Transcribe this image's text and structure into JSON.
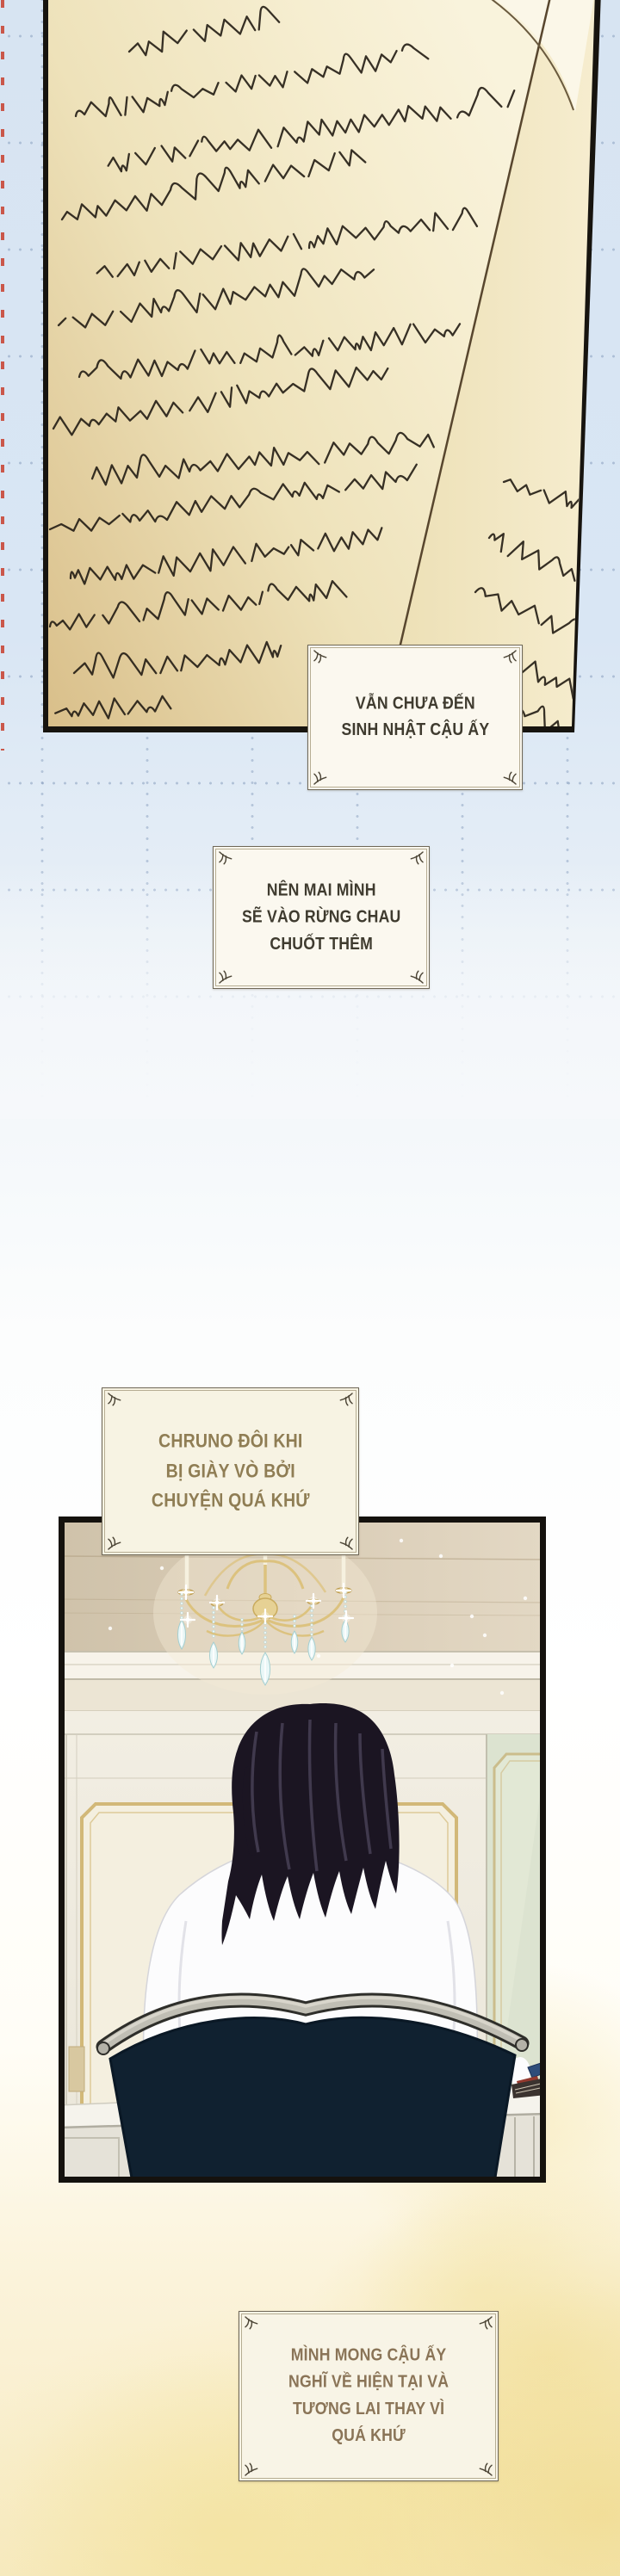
{
  "captions": {
    "journal_note_1": {
      "text": "VẪN CHƯA ĐẾN\nSINH NHẬT CẬU ẤY"
    },
    "journal_note_2": {
      "text": "NÊN MAI MÌNH\nSẼ VÀO RỪNG CHAU\nCHUỐT THÊM"
    },
    "narration_1": {
      "text": "CHRUNO ĐÔI KHI\nBỊ GIÀY VÒ BỞI\nCHUYỆN QUÁ KHỨ"
    },
    "narration_2": {
      "text": "MÌNH MONG CẬU ẤY\nNGHĨ VỀ HIỆN TẠI VÀ\nTƯƠNG LAI THAY VÌ\nQUÁ KHỨ"
    }
  },
  "colors": {
    "background_blue": "#d9e6f4",
    "paper_cream": "#e9d7a6",
    "caption_box_bg": "#f9f5ea",
    "caption_dark_text": "#3f3b2f",
    "caption_olive_text": "#8f7d54",
    "panel_wall_beige": "#d8cbb5",
    "chair_navy": "#102130",
    "accent_gold": "#d2b878",
    "yellow_wash": "#f5e7b8",
    "margin_line_red": "#c73e2d"
  }
}
